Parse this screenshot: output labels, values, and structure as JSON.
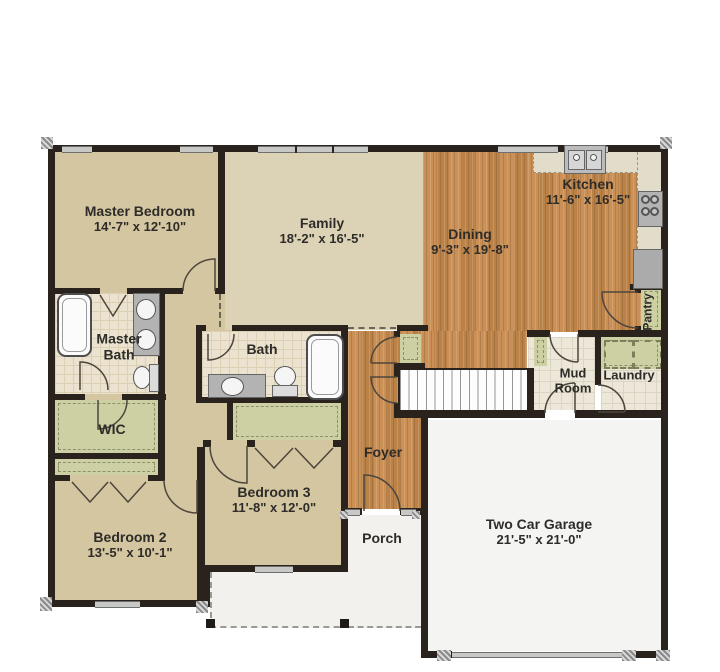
{
  "page_title": "First Floor Plan",
  "rooms": [
    {
      "name": "Master Bedroom",
      "dims": "14'-7\" x 12'-10\""
    },
    {
      "name": "Family",
      "dims": "18'-2\" x 16'-5\""
    },
    {
      "name": "Dining",
      "dims": "9'-3\" x 19'-8\""
    },
    {
      "name": "Kitchen",
      "dims": "11'-6\" x 16'-5\""
    },
    {
      "name": "Master Bath",
      "dims": ""
    },
    {
      "name": "Bath",
      "dims": ""
    },
    {
      "name": "WIC",
      "dims": ""
    },
    {
      "name": "Mud Room",
      "dims": ""
    },
    {
      "name": "Laundry",
      "dims": ""
    },
    {
      "name": "Pantry",
      "dims": ""
    },
    {
      "name": "Foyer",
      "dims": ""
    },
    {
      "name": "Bedroom 3",
      "dims": "11'-8\" x 12'-0\""
    },
    {
      "name": "Bedroom 2",
      "dims": "13'-5\" x 10'-1\""
    },
    {
      "name": "Porch",
      "dims": ""
    },
    {
      "name": "Two Car Garage",
      "dims": "21'-5\" x 21'-0\""
    }
  ],
  "fixtures": [
    "bathtub",
    "double-vanity-sinks",
    "toilet",
    "vanity-sink",
    "kitchen-double-sink",
    "stove",
    "refrigerator",
    "washer",
    "dryer",
    "stairs",
    "mud-bench",
    "porch-posts",
    "garage-door"
  ],
  "colors": {
    "wall": "#2a231d",
    "wood_floor": "#c78a4d",
    "bedroom_tan": "#d4c6a0",
    "family_tan": "#dcd3b6",
    "bath_tile": "#ebe3d0",
    "closet_green": "#ccd0a2",
    "garage": "#f4f4f2",
    "porch": "#f2f1ee",
    "window": "#c8c8c6"
  }
}
